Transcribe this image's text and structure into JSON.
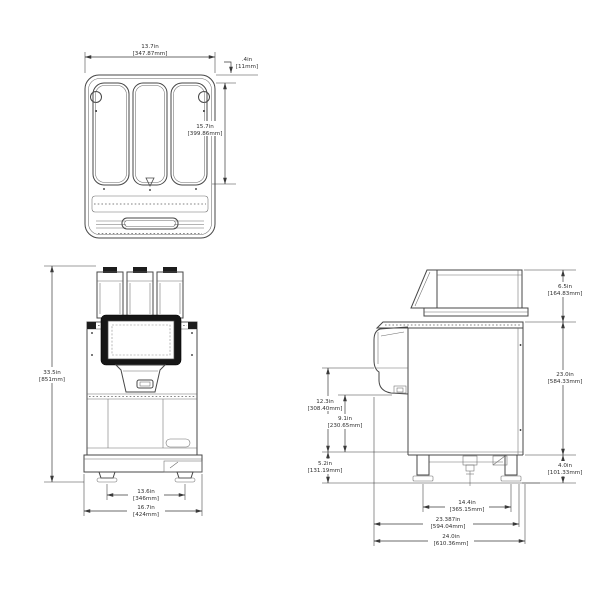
{
  "drawing_title": "beverage-machine-dimension-drawing",
  "dims": {
    "top": {
      "width": {
        "in": "13.7in",
        "mm": "[347.87mm]"
      },
      "lid_offset": {
        "in": ".4in",
        "mm": "[11mm]"
      },
      "depth": {
        "in": "15.7in",
        "mm": "[399.86mm]"
      }
    },
    "front": {
      "height": {
        "in": "33.5in",
        "mm": "[851mm]"
      },
      "foot_span": {
        "in": "13.6in",
        "mm": "[346mm]"
      },
      "width": {
        "in": "16.7in",
        "mm": "[424mm]"
      }
    },
    "side": {
      "hopper_height": {
        "in": "6.5in",
        "mm": "[164.83mm]"
      },
      "body_height": {
        "in": "23.0in",
        "mm": "[584.33mm]"
      },
      "leg_height": {
        "in": "4.0in",
        "mm": "[101.33mm]"
      },
      "dispense_clearance": {
        "in": "12.3in",
        "mm": "[308.40mm]"
      },
      "cup_clearance": {
        "in": "9.1in",
        "mm": "[230.65mm]"
      },
      "base_clearance": {
        "in": "5.2in",
        "mm": "[131.19mm]"
      },
      "leg_span": {
        "in": "14.4in",
        "mm": "[365.15mm]"
      },
      "body_depth": {
        "in": "23.387in",
        "mm": "[594.04mm]"
      },
      "overall_depth": {
        "in": "24.0in",
        "mm": "[610.36mm]"
      }
    }
  }
}
